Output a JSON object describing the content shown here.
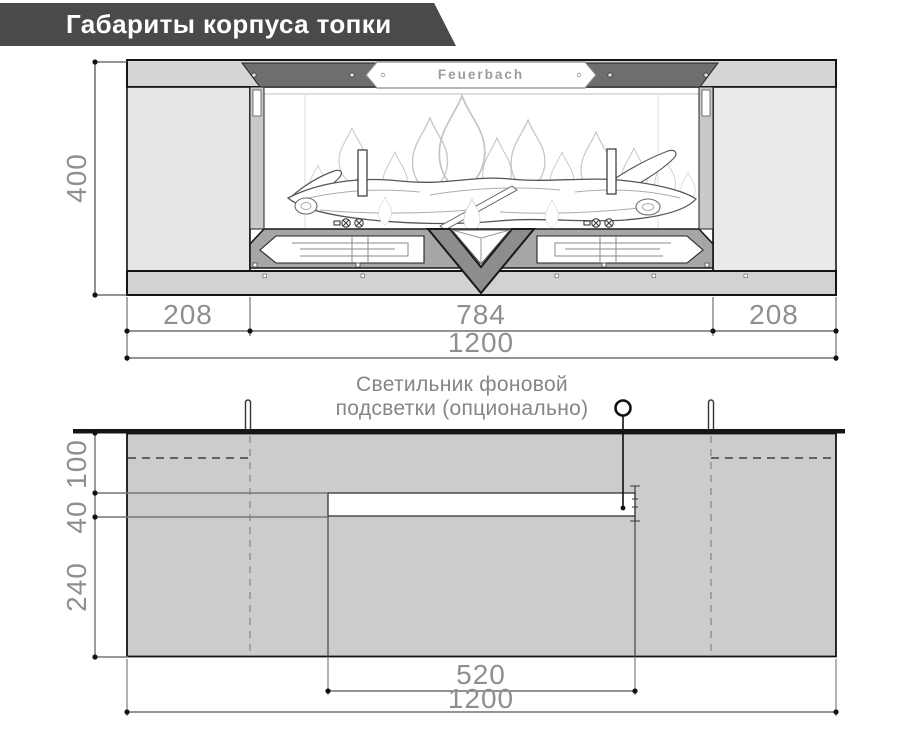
{
  "banner": {
    "title": "Габариты корпуса топки"
  },
  "brand": {
    "nameplate_text": "Feuerbach"
  },
  "front_view": {
    "dims": {
      "height": "400",
      "left_panel": "208",
      "firebox": "784",
      "right_panel": "208",
      "total_width": "1200"
    }
  },
  "plan_view": {
    "note": {
      "line1": "Светильник фоновой",
      "line2": "подсветки (опционально)"
    },
    "dims": {
      "front_depth": "100",
      "slot_depth": "40",
      "rear_depth": "240",
      "slot_width": "520",
      "total_width": "1200"
    }
  },
  "colors": {
    "banner_bg": "#4a4a4a",
    "plan_body_gray": "#cccccc",
    "panel_gray": "#e6e6e6",
    "trim_dark_gray": "#6e6e6e",
    "dim_text_gray": "#8f8f8f"
  }
}
